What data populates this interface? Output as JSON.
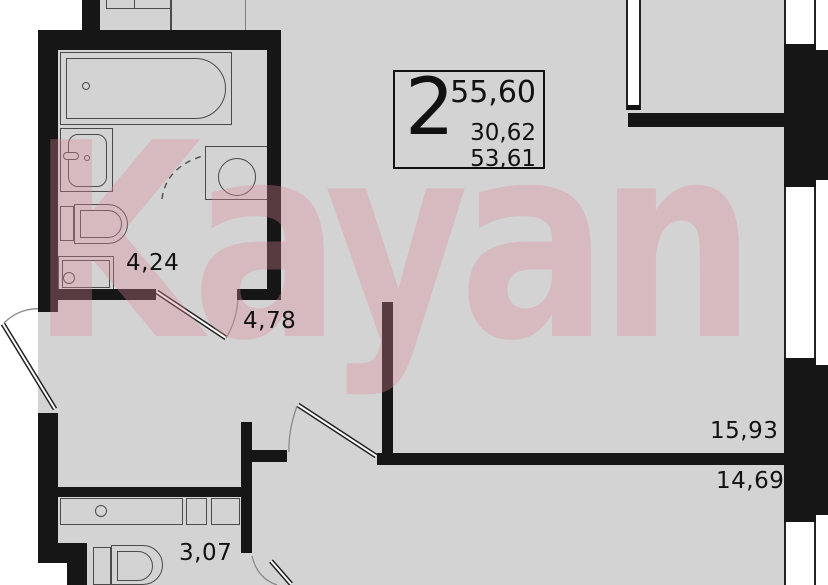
{
  "watermark": {
    "text": "Kayan"
  },
  "title_block": {
    "rooms": "2",
    "total_area": "55,60",
    "living_area": "30,62",
    "reduced_area": "53,61"
  },
  "rooms": [
    {
      "name": "bathroom",
      "area": "4,24"
    },
    {
      "name": "hallway",
      "area": "4,78"
    },
    {
      "name": "kitchen-living-room",
      "area": "15,93"
    },
    {
      "name": "bedroom",
      "area": "14,69"
    },
    {
      "name": "bathroom-2",
      "area": "3,07"
    }
  ],
  "colors": {
    "floor": "#d3d3d3",
    "wall": "#161616",
    "fixture_outline": "#4a4a4a",
    "watermark_pink": "rgba(221,138,152,0.33)",
    "label_text": "#111111"
  }
}
